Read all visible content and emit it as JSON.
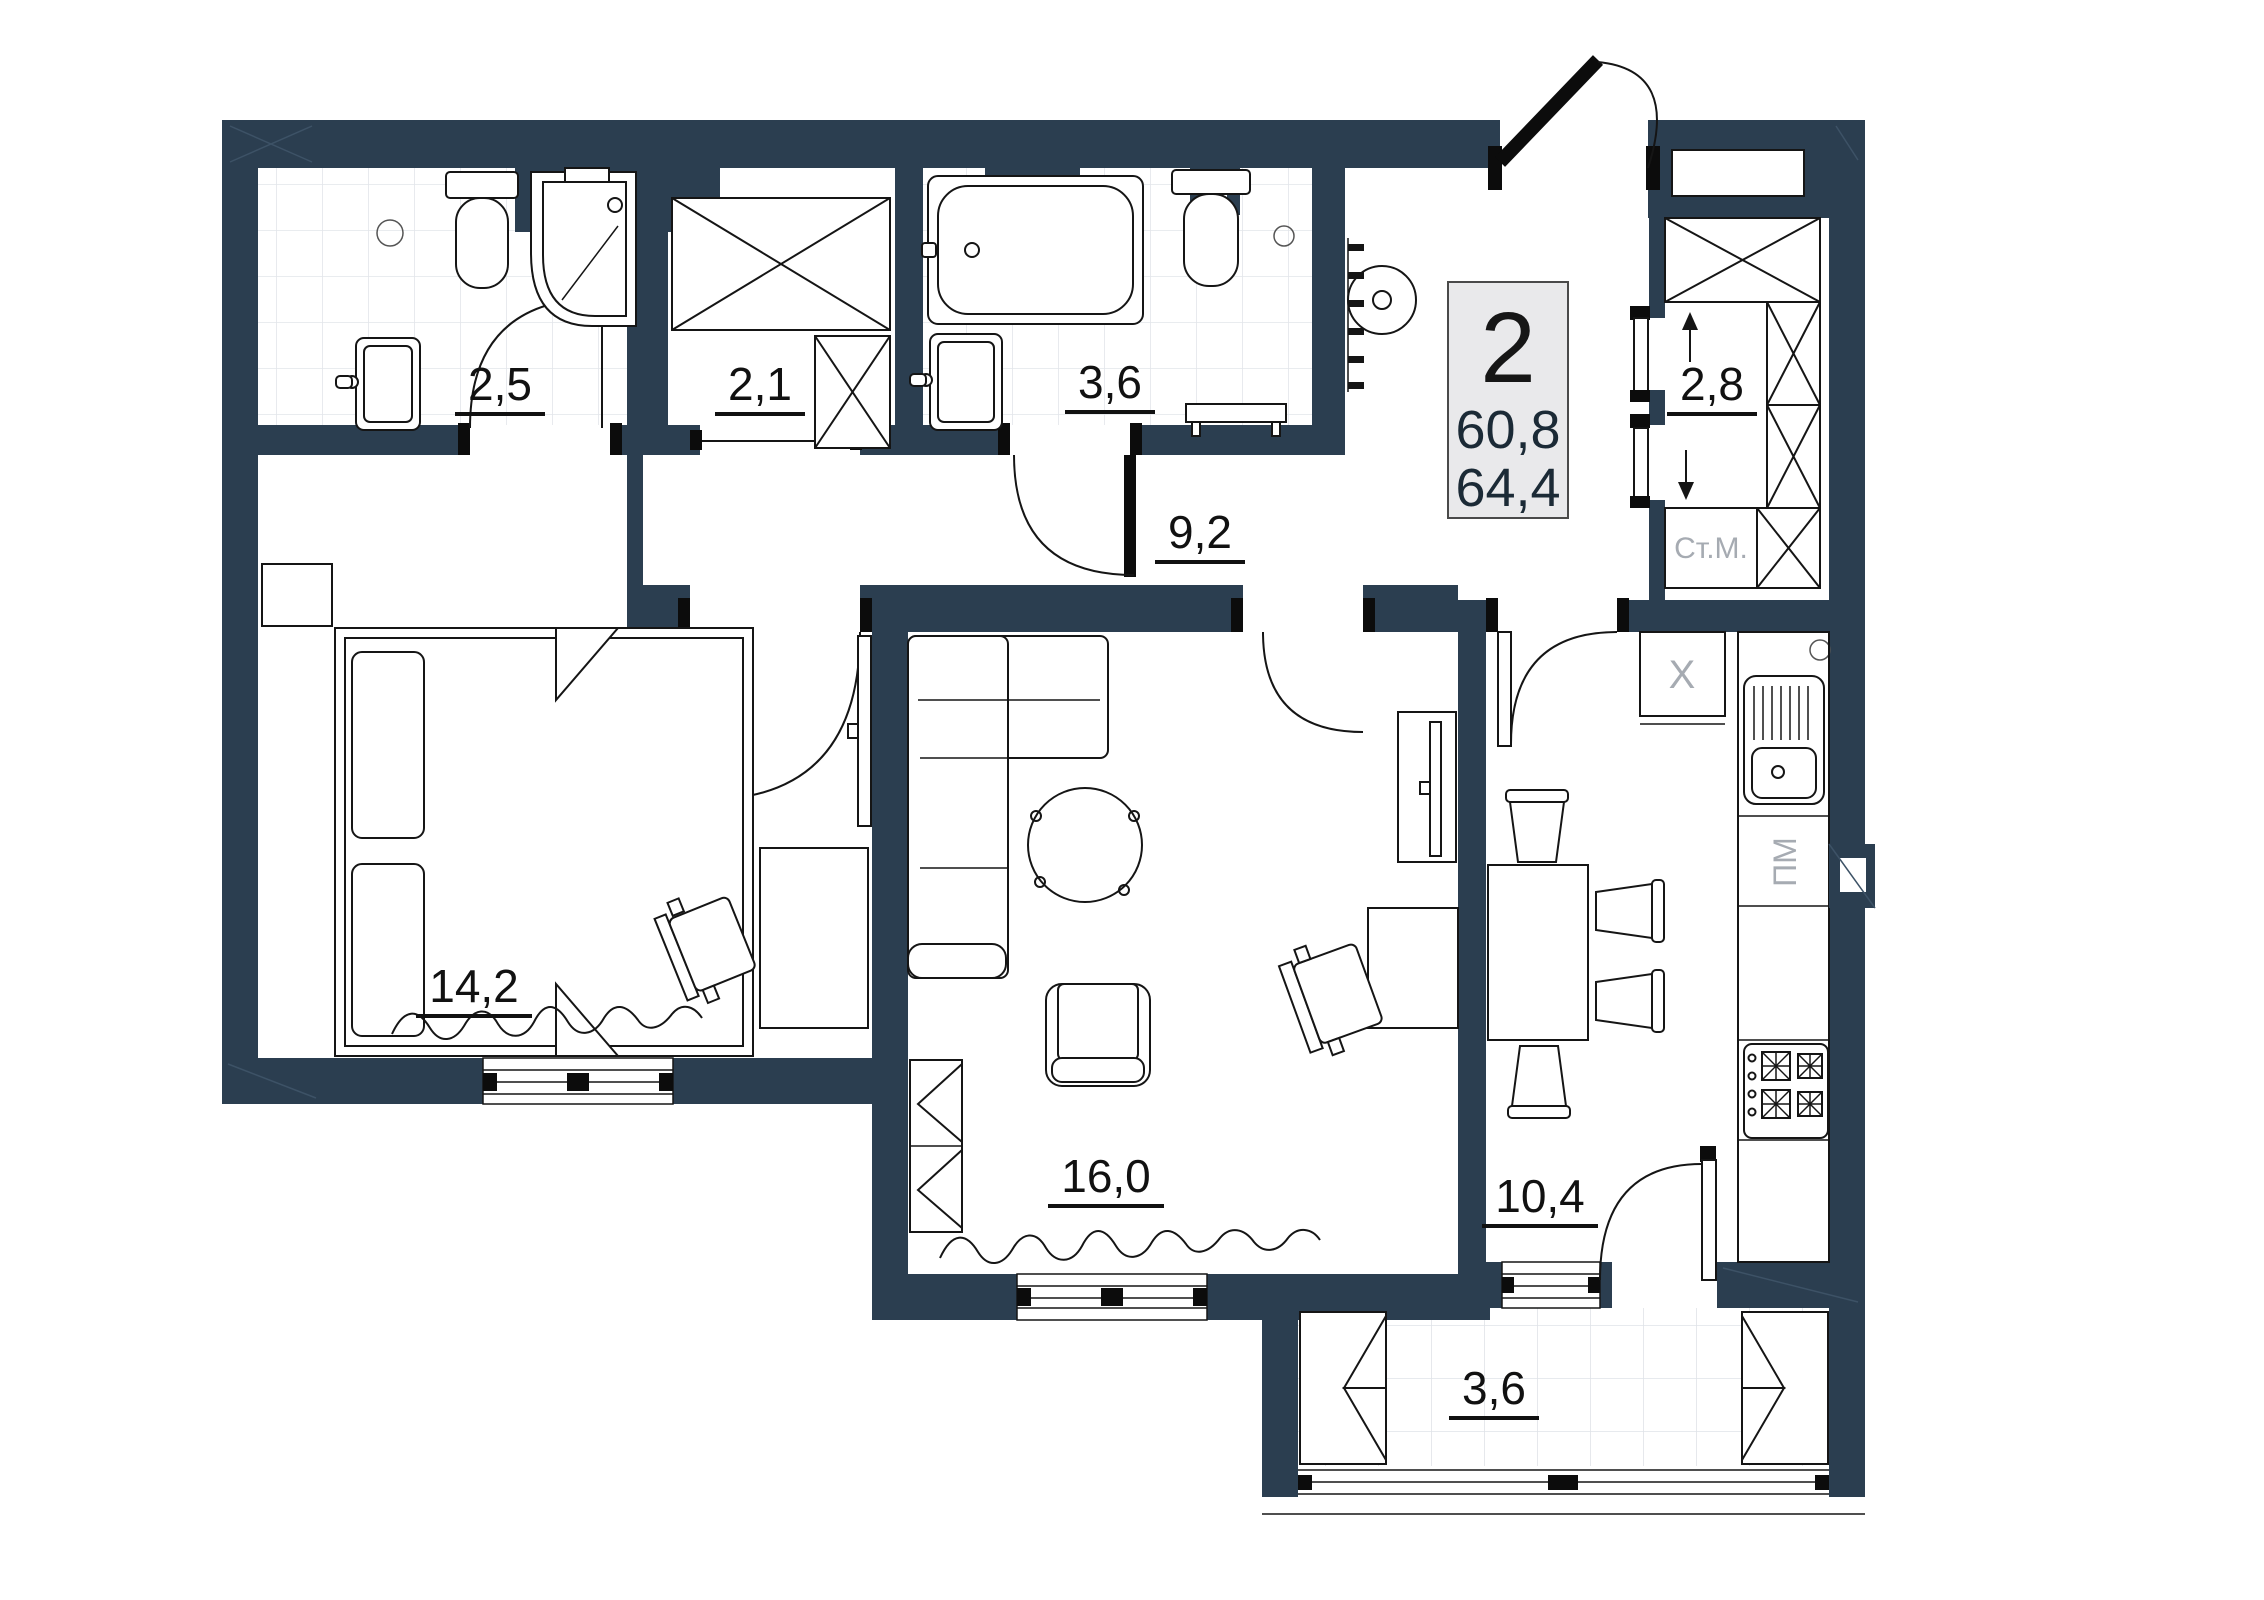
{
  "plan": {
    "title": "2-room apartment floor plan",
    "unit_badge": {
      "rooms": "2",
      "area_living": "60,8",
      "area_total": "64,4"
    },
    "rooms": [
      {
        "id": "bath-small",
        "area": "2,5"
      },
      {
        "id": "wardrobe",
        "area": "2,1"
      },
      {
        "id": "bath-big",
        "area": "3,6"
      },
      {
        "id": "hallway",
        "area": "9,2"
      },
      {
        "id": "pantry",
        "area": "2,8"
      },
      {
        "id": "bedroom",
        "area": "14,2"
      },
      {
        "id": "living",
        "area": "16,0"
      },
      {
        "id": "kitchen",
        "area": "10,4"
      },
      {
        "id": "balcony",
        "area": "3,6"
      }
    ],
    "annotations": {
      "washing_machine": "Ст.М.",
      "dishwasher": "ПМ",
      "vent": "X"
    },
    "colors": {
      "wall": "#2b3e50",
      "line": "#151515",
      "muted": "#a6abb2",
      "tile": "#e2e5ea",
      "badge_bg": "#e9e9eb"
    }
  }
}
